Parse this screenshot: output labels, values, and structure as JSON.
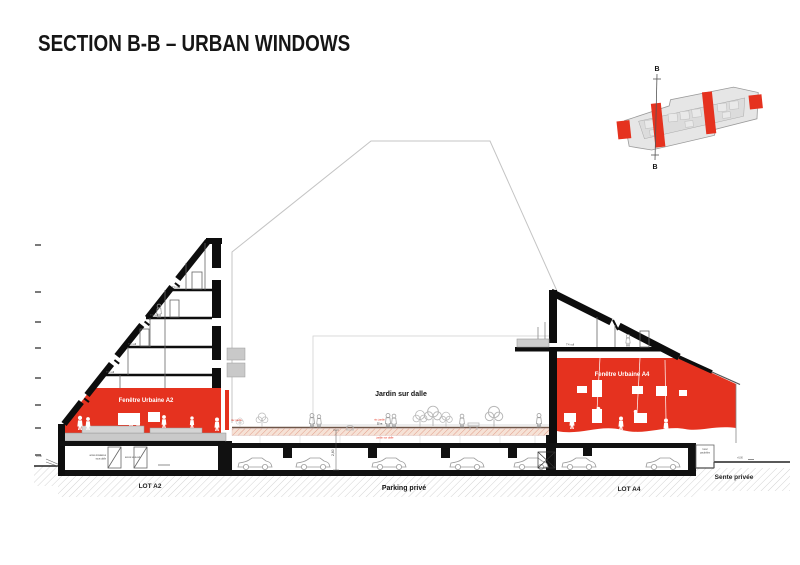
{
  "title": "SECTION B-B – URBAN WINDOWS",
  "colors": {
    "accent_red": "#e5321f",
    "plan_gray": "#e6e6e6",
    "ground_hatch": "#d4d4d4"
  },
  "key_plan": {
    "label_top": "B",
    "label_bottom": "B"
  },
  "left_building": {
    "urban_window_label": "Fenêtre Urbaine A2",
    "lot_label": "LOT A2",
    "floor_labels": [
      "T4 sdl",
      "T4 sdl",
      "T4 sdl",
      "T4 sdl"
    ]
  },
  "right_building": {
    "urban_window_label": "Fenêtre Urbaine A4",
    "lot_label": "LOT A4",
    "floor_label": "T4 sdl",
    "bin_room_line1": "local",
    "bin_room_line2": "poubelles"
  },
  "garden": {
    "label": "Jardin sur dalle",
    "level_label": "niv. jardin",
    "dim_label": "32 m",
    "slab_label": "jardin sur dalle"
  },
  "parking": {
    "label": "Parking privé",
    "height_dim": "2,60"
  },
  "sente": {
    "label": "Sente privée",
    "level_label": "+0,00"
  },
  "annotations": {
    "access_line1": "accès locataires",
    "access_line2": "sous dalle",
    "access_2": "accès sous-sol",
    "level_left": "+0,00"
  }
}
